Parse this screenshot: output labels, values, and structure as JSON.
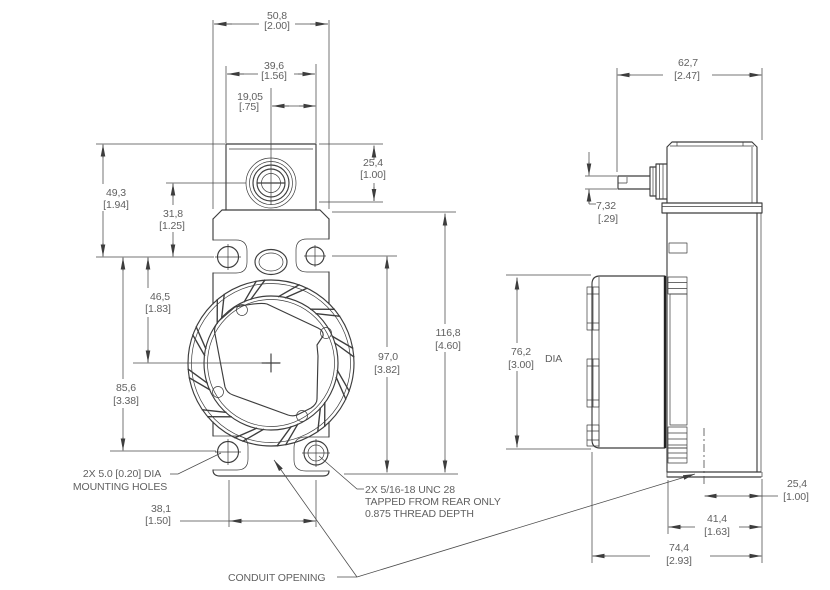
{
  "drawing": {
    "front_view": {
      "dims": {
        "overall_width": {
          "mm": "50,8",
          "in": "[2.00]"
        },
        "block_width": {
          "mm": "39,6",
          "in": "[1.56]"
        },
        "port_to_edge": {
          "mm": "19,05",
          "in": "[.75]"
        },
        "block_top_to_upper_holes": {
          "mm": "49,3",
          "in": "[1.94]"
        },
        "port_to_upper_holes": {
          "mm": "31,8",
          "in": "[1.25]"
        },
        "upper_holes_to_center": {
          "mm": "46,5",
          "in": "[1.83]"
        },
        "upper_to_lower_holes": {
          "mm": "85,6",
          "in": "[3.38]"
        },
        "block_height": {
          "mm": "25,4",
          "in": "[1.00]"
        },
        "body_height": {
          "mm": "116,8",
          "in": "[4.60]"
        },
        "upper_holes_to_bottom": {
          "mm": "97,0",
          "in": "[3.82]"
        },
        "lower_hole_spacing": {
          "mm": "38,1",
          "in": "[1.50]"
        }
      },
      "notes": {
        "mounting_line1": "2X 5.0 [0.20] DIA",
        "mounting_line2": "MOUNTING HOLES",
        "tapped_line1": "2X 5/16-18 UNC 28",
        "tapped_line2": "TAPPED FROM REAR ONLY",
        "tapped_line3": "0.875 THREAD DEPTH",
        "conduit": "CONDUIT OPENING"
      }
    },
    "side_view": {
      "dims": {
        "housing_depth": {
          "mm": "62,7",
          "in": "[2.47]"
        },
        "stem_height": {
          "mm": "7,32",
          "in": "[.29]"
        },
        "dial_diameter": {
          "mm": "76,2",
          "in": "[3.00]",
          "suffix": "DIA"
        },
        "conduit_to_rear": {
          "mm": "25,4",
          "in": "[1.00]"
        },
        "base_depth": {
          "mm": "41,4",
          "in": "[1.63]"
        },
        "overall_depth": {
          "mm": "74,4",
          "in": "[2.93]"
        }
      }
    },
    "colors": {
      "line": "#3d3d3d",
      "text": "#616161",
      "background": "#ffffff"
    }
  }
}
